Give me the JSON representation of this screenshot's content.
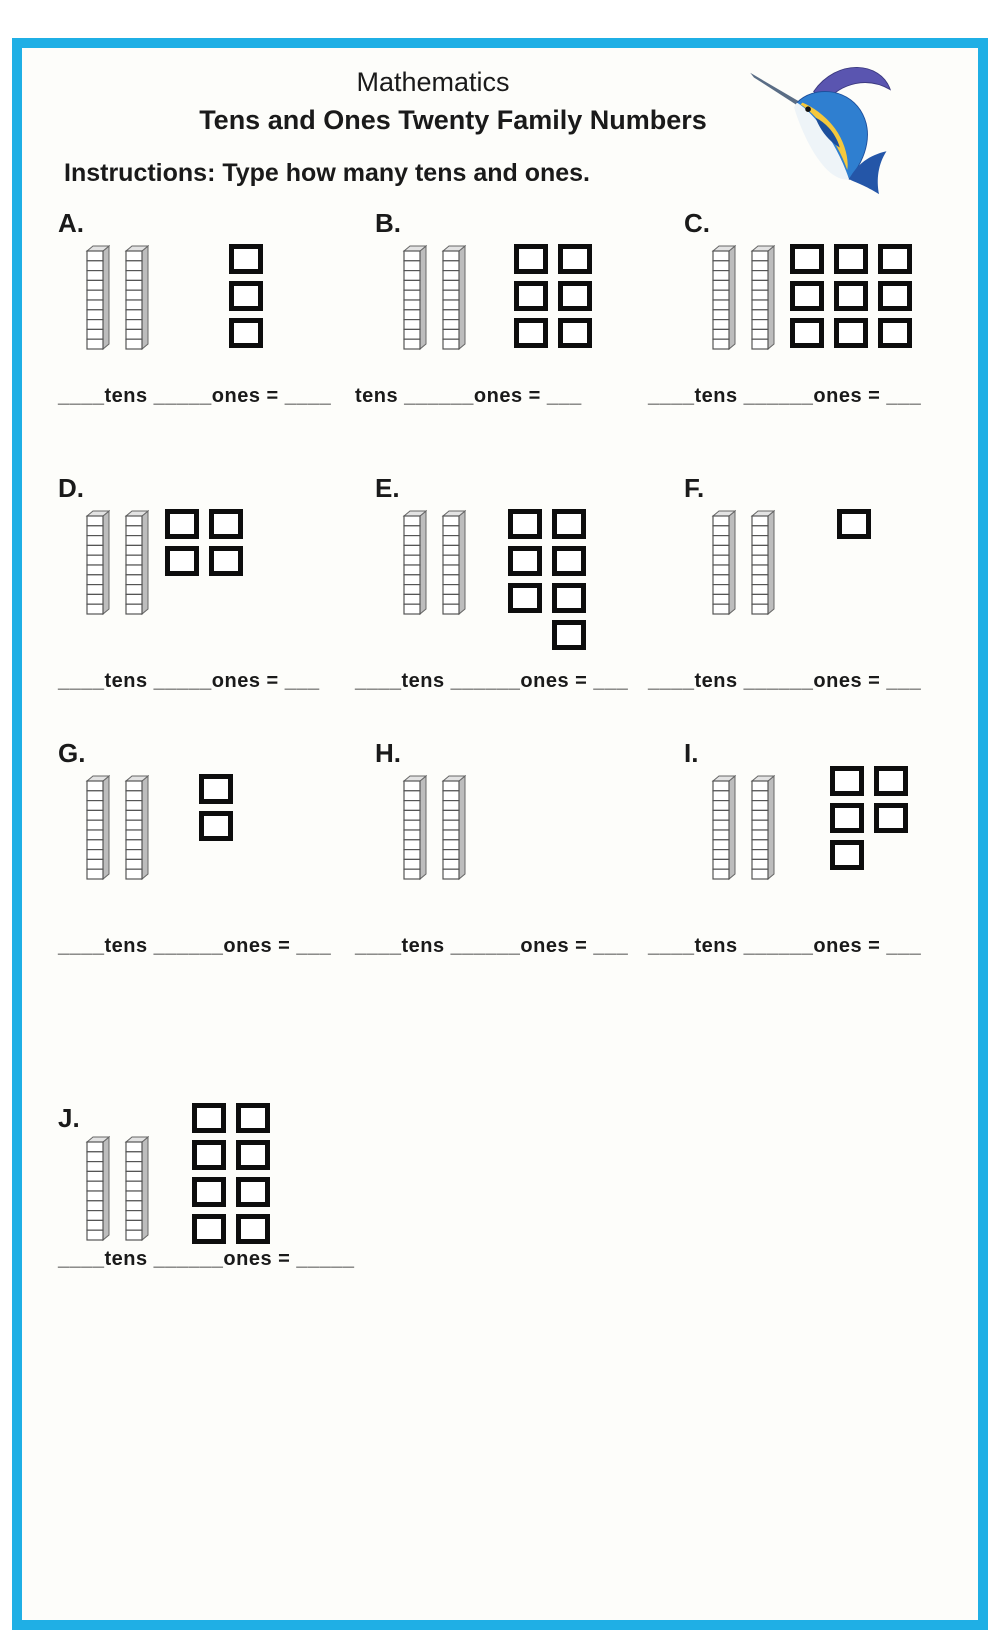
{
  "page": {
    "border_color": "#1fafe5",
    "background_color": "#fdfdfa",
    "square_border_color": "#0d0d0d"
  },
  "header": {
    "title": "Mathematics",
    "subtitle": "Tens and Ones Twenty Family Numbers",
    "instructions": "Instructions: Type how many tens and ones."
  },
  "icons": {
    "fish": "marlin-fish-image",
    "rod": "base-ten-rod",
    "one": "base-ten-one-block"
  },
  "problems": [
    {
      "label": "A.",
      "tens": 2,
      "ones": 3,
      "ones_grid": [
        [
          1
        ],
        [
          1
        ],
        [
          1
        ]
      ],
      "answer_line": "____tens _____ones = ____"
    },
    {
      "label": "B.",
      "tens": 2,
      "ones": 6,
      "ones_grid": [
        [
          1,
          1
        ],
        [
          1,
          1
        ],
        [
          1,
          1
        ]
      ],
      "answer_line": "tens ______ones = ___"
    },
    {
      "label": "C.",
      "tens": 2,
      "ones": 9,
      "ones_grid": [
        [
          1,
          1,
          1
        ],
        [
          1,
          1,
          1
        ],
        [
          1,
          1,
          1
        ]
      ],
      "answer_line": "____tens ______ones = ___"
    },
    {
      "label": "D.",
      "tens": 2,
      "ones": 4,
      "ones_grid": [
        [
          1,
          1
        ],
        [
          1,
          1
        ]
      ],
      "answer_line": "____tens _____ones = ___"
    },
    {
      "label": "E.",
      "tens": 2,
      "ones": 7,
      "ones_grid": [
        [
          1,
          1
        ],
        [
          1,
          1
        ],
        [
          1,
          1
        ],
        [
          0,
          1
        ]
      ],
      "answer_line": "____tens ______ones = ___"
    },
    {
      "label": "F.",
      "tens": 2,
      "ones": 1,
      "ones_grid": [
        [
          1
        ]
      ],
      "answer_line": "____tens ______ones = ___"
    },
    {
      "label": "G.",
      "tens": 2,
      "ones": 2,
      "ones_grid": [
        [
          1
        ],
        [
          1
        ]
      ],
      "answer_line": "____tens ______ones = ___"
    },
    {
      "label": "H.",
      "tens": 2,
      "ones": 0,
      "ones_grid": [],
      "answer_line": "____tens ______ones = ___"
    },
    {
      "label": "I.",
      "tens": 2,
      "ones": 5,
      "ones_grid": [
        [
          1,
          1
        ],
        [
          1,
          1
        ],
        [
          1,
          0
        ]
      ],
      "answer_line": "____tens ______ones = ___"
    },
    {
      "label": "J.",
      "tens": 2,
      "ones": 8,
      "ones_grid": [
        [
          1,
          1
        ],
        [
          1,
          1
        ],
        [
          1,
          1
        ],
        [
          1,
          1
        ]
      ],
      "answer_line": "____tens ______ones = _____"
    }
  ]
}
